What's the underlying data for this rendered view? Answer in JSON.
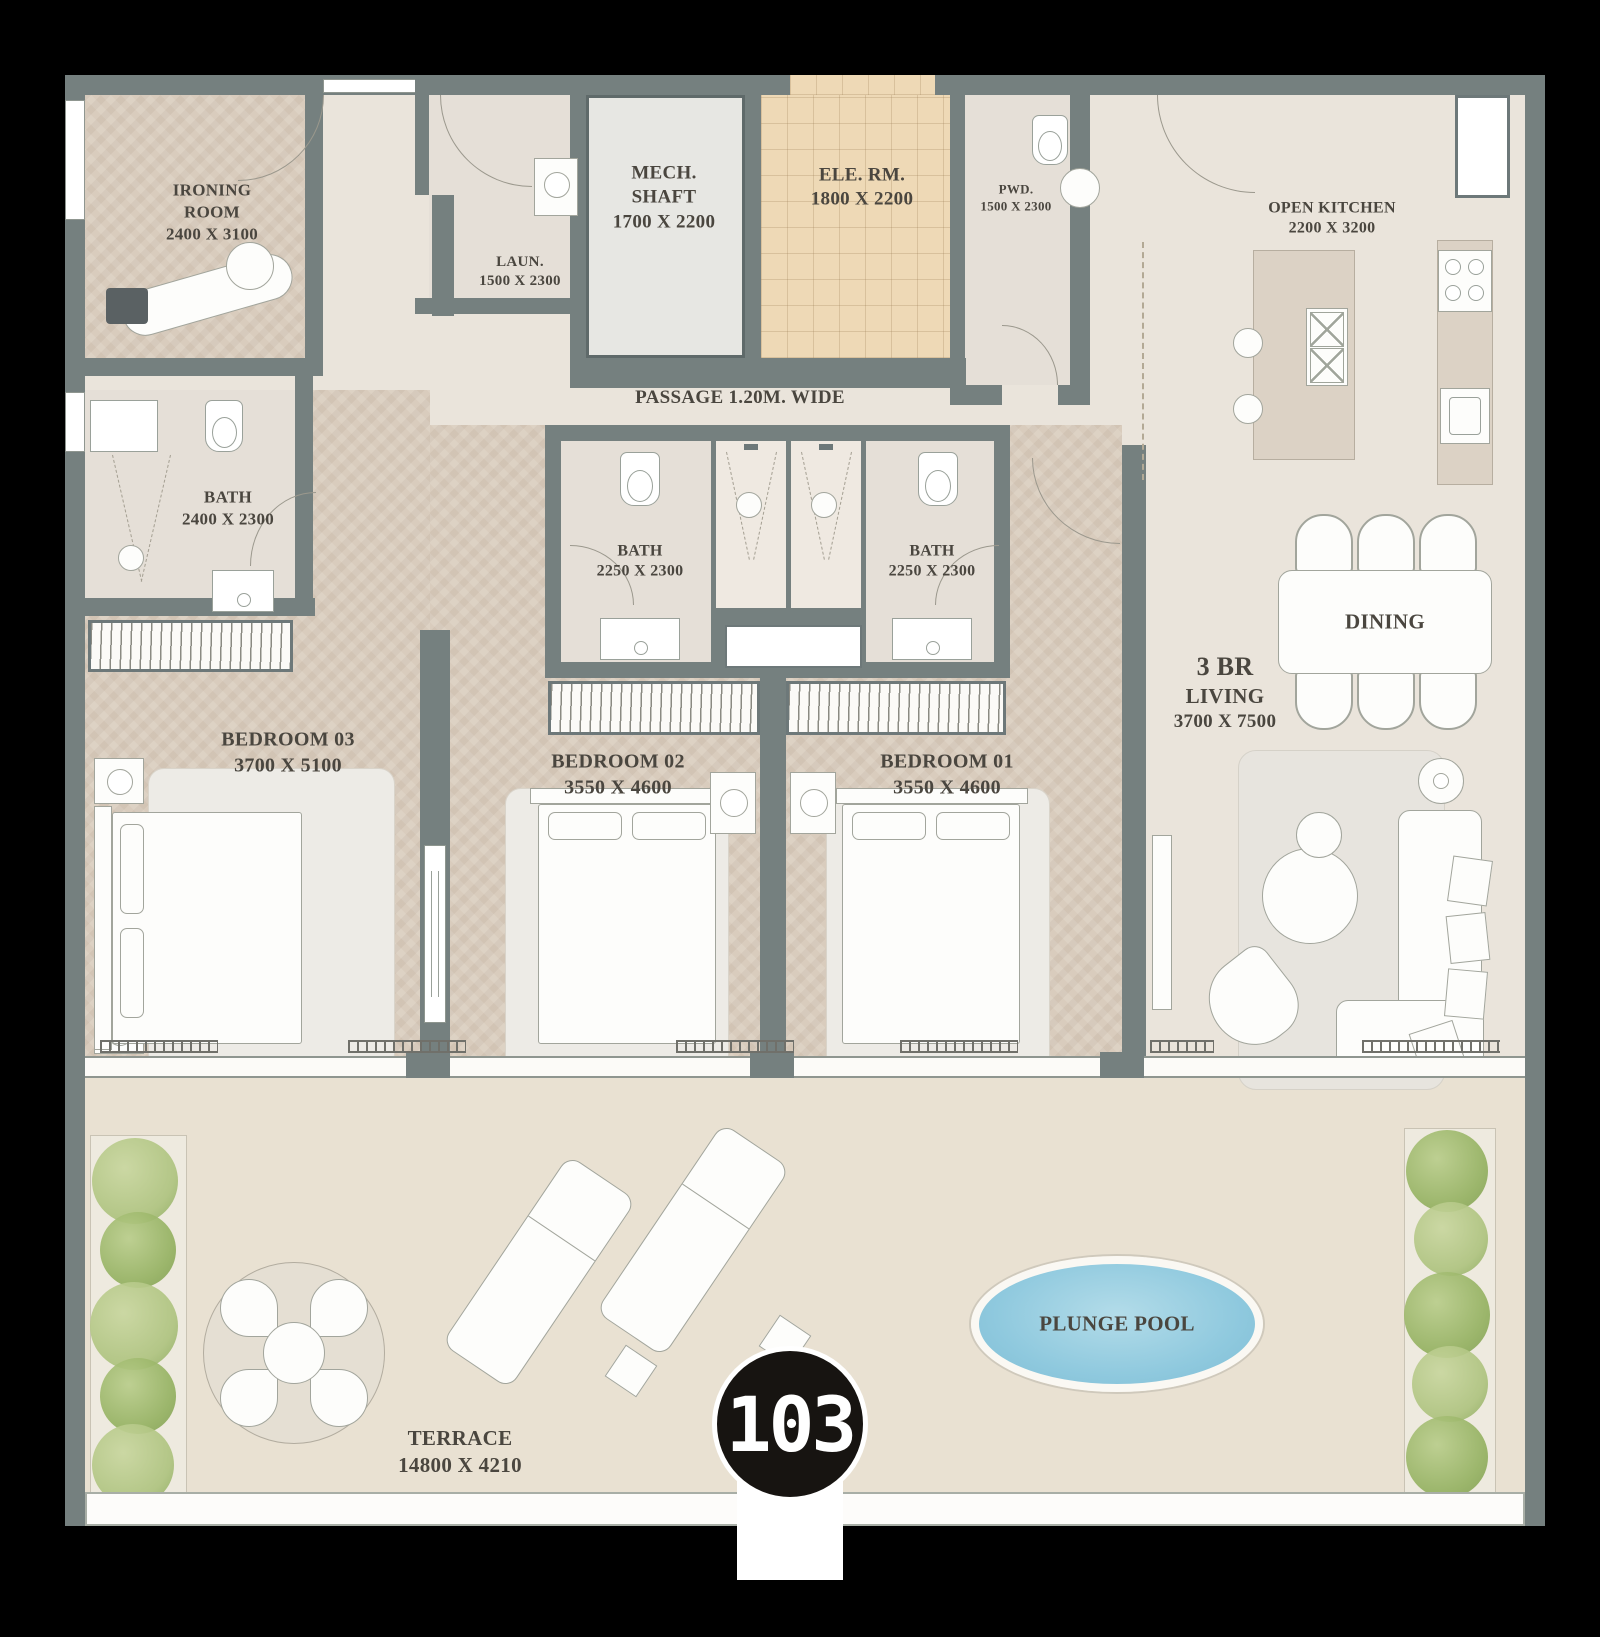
{
  "unit": {
    "badge": "103"
  },
  "rooms": {
    "ironing": {
      "name1": "IRONING",
      "name2": "ROOM",
      "dims": "2400 X 3100"
    },
    "laundry": {
      "name1": "LAUN.",
      "dims": "1500 X 2300"
    },
    "mech": {
      "name1": "MECH.",
      "name2": "SHAFT",
      "dims": "1700 X 2200"
    },
    "ele": {
      "name1": "ELE. RM.",
      "dims": "1800 X 2200"
    },
    "pwd": {
      "name1": "PWD.",
      "dims": "1500 X 2300"
    },
    "kitchen": {
      "name1": "OPEN KITCHEN",
      "dims": "2200 X 3200"
    },
    "passage": {
      "name1": "PASSAGE 1.20M. WIDE"
    },
    "bath_master": {
      "name1": "BATH",
      "dims": "2400 X 2300"
    },
    "bath_02": {
      "name1": "BATH",
      "dims": "2250 X 2300"
    },
    "bath_01": {
      "name1": "BATH",
      "dims": "2250 X 2300"
    },
    "bedroom_03": {
      "name1": "BEDROOM 03",
      "dims": "3700 X 5100"
    },
    "bedroom_02": {
      "name1": "BEDROOM 02",
      "dims": "3550 X 4600"
    },
    "bedroom_01": {
      "name1": "BEDROOM 01",
      "dims": "3550 X 4600"
    },
    "living": {
      "name1": "3 BR",
      "name2": "LIVING",
      "dims": "3700 X 7500"
    },
    "dining": {
      "name1": "DINING"
    },
    "terrace": {
      "name1": "TERRACE",
      "dims": "14800 X 4210"
    },
    "pool": {
      "name1": "PLUNGE POOL"
    }
  },
  "colors": {
    "wall": "#75807f",
    "floor": "#eae4db",
    "wood_floor": "#d9ccbd",
    "tile_floor": "#eed9b6",
    "bath_floor": "#e5dfd7",
    "terrace_floor": "#e9e1d2",
    "pool": "#8cc7dd",
    "greenery": "#a3bd74",
    "badge_background": "#171411",
    "badge_text": "#ffffff",
    "label_ink": "#4a463f"
  }
}
